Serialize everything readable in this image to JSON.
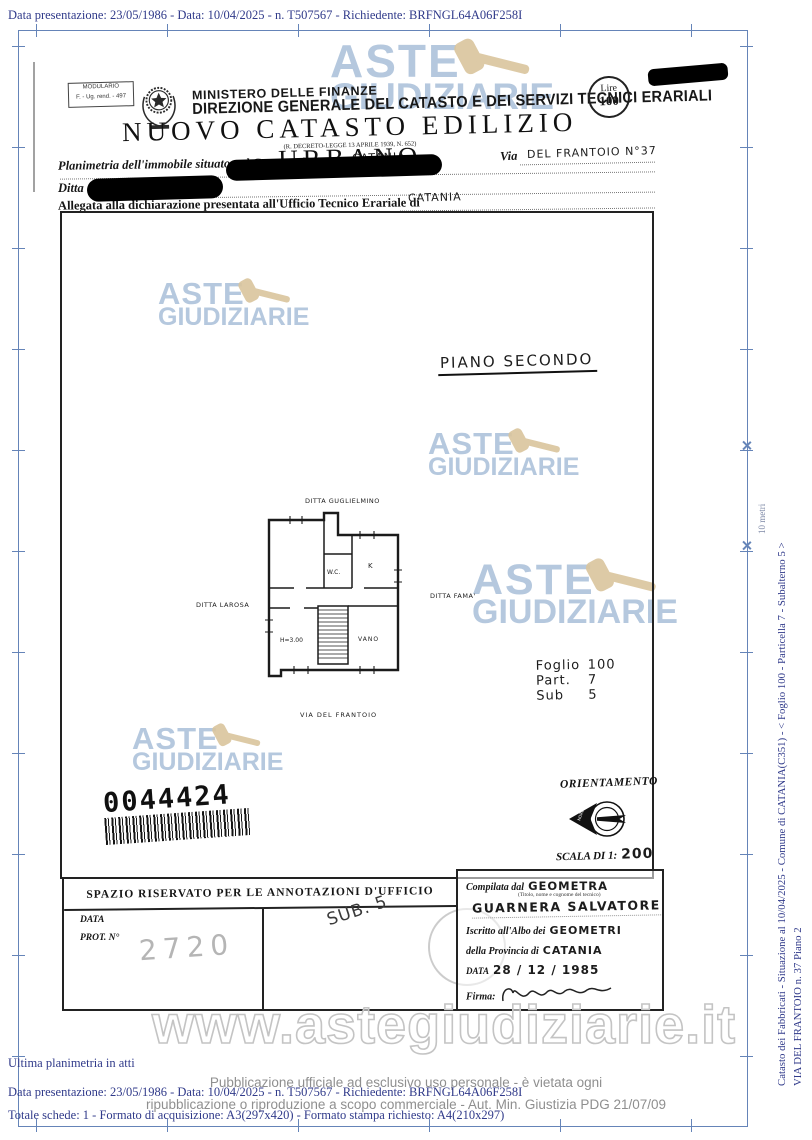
{
  "page": {
    "top_line": "Data presentazione: 23/05/1986 - Data: 10/04/2025 - n. T507567 - Richiedente: BRFNGL64A06F258I",
    "side": {
      "line1": "Catasto dei Fabbricati - Situazione al 10/04/2025 - Comune di CATANIA(C351) - < Foglio 100 - Particella 7 - Subalterno 5 >",
      "line2": "VIA DEL FRANTOIO n. 37 Piano 2",
      "scale_label": "10 metri"
    },
    "footer": {
      "ultima": "Ultima planimetria in atti",
      "line1": "Data presentazione: 23/05/1986 - Data: 10/04/2025 - n. T507567 - Richiedente: BRFNGL64A06F258I",
      "line2": "Totale schede: 1 - Formato di acquisizione: A3(297x420) - Formato stampa richiesto: A4(210x297)",
      "url": "www.astegiudiziarie.it",
      "disc1": "Pubblicazione ufficiale ad esclusivo uso personale - è vietata ogni",
      "disc2": "ripubblicazione o riproduzione a scopo commerciale - Aut. Min. Giustizia PDG 21/07/09"
    }
  },
  "watermark": {
    "aste": "ASTE",
    "giudiziarie": "GIUDIZIARIE"
  },
  "header": {
    "modulario_line1": "MODULARIO",
    "modulario_line2": "F. - Ug. rend. - 497",
    "ministero": "MINISTERO DELLE FINANZE",
    "direzione": "DIREZIONE GENERALE DEL CATASTO E DEI SERVIZI TECNICI ERARIALI",
    "lire_label": "Lire",
    "lire_value": "100",
    "title": "NUOVO CATASTO EDILIZIO URBANO",
    "subtitle": "(R. DECRETO-LEGGE 13 APRILE 1939, N. 652)",
    "planimetria_label": "Planimetria dell'immobile situato nel Comune di",
    "comune_value": "CATANIA",
    "via_label": "Via",
    "via_value": "DEL FRANTOIO N°37",
    "ditta_label": "Ditta",
    "allegata_label": "Allegata alla dichiarazione presentata all'Ufficio Tecnico Erariale di",
    "ufficio_value": "CATANIA"
  },
  "plan": {
    "piano_label": "PIANO SECONDO",
    "ditta_top": "DITTA GUGLIELMINO",
    "ditta_left": "DITTA LAROSA",
    "ditta_right": "DITTA FAMA'",
    "via_bottom": "VIA DEL FRANTOIO",
    "rooms": {
      "wc": "W.C.",
      "k": "K",
      "vano": "VANO",
      "height": "H=3.00"
    },
    "ref": {
      "rows": [
        {
          "label": "Foglio",
          "value": "100"
        },
        {
          "label": "Part.",
          "value": "7"
        },
        {
          "label": "Sub",
          "value": "5"
        }
      ]
    },
    "barcode": "0044424",
    "orientamento": "ORIENTAMENTO",
    "compass_nord": "NORD",
    "scala_label": "SCALA DI 1:",
    "scala_value": "200"
  },
  "annotations": {
    "title": "SPAZIO RISERVATO PER LE ANNOTAZIONI D'UFFICIO",
    "data_label": "DATA",
    "prot_label": "PROT. N°",
    "prot_value": "2720",
    "sub_note": "SUB. 5"
  },
  "signature": {
    "compilata_label": "Compilata dal",
    "compilata_value": "GEOMETRA",
    "titolo_note": "(Titolo, nome e cognome del tecnico)",
    "name": "GUARNERA SALVATORE",
    "albo_label": "Iscritto all'Albo dei",
    "albo_value": "GEOMETRI",
    "provincia_label": "della Provincia di",
    "provincia_value": "CATANIA",
    "data_label": "DATA",
    "data_value": "28 / 12 / 1985",
    "firma_label": "Firma:"
  }
}
